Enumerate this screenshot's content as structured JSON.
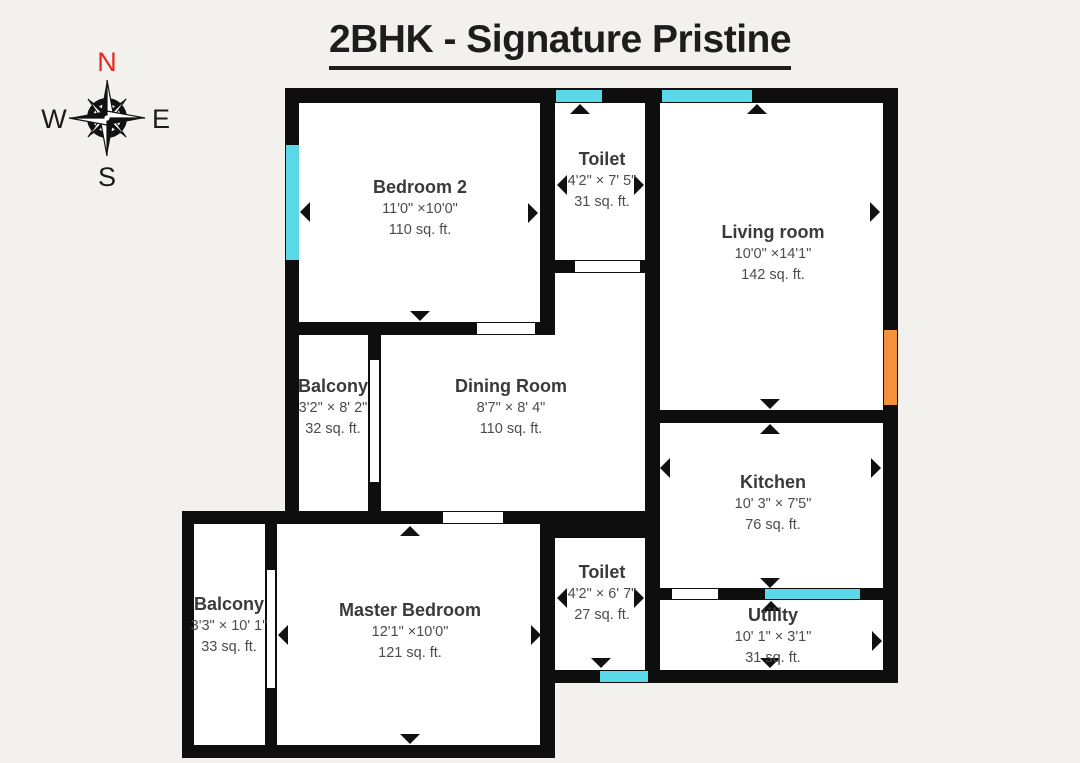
{
  "title": "2BHK - Signature Pristine",
  "compass": {
    "north": "N",
    "south": "S",
    "east": "E",
    "west": "W"
  },
  "colors": {
    "background": "#f2f1ed",
    "wall": "#0e0e0e",
    "room_fill": "#ffffff",
    "window": "#5ad8e8",
    "main_door": "#f5913d",
    "north_label": "#e8281e",
    "text": "#3a3a3a"
  },
  "rooms": [
    {
      "id": "bedroom2",
      "name": "Bedroom 2",
      "dimensions": "11'0\" ×10'0\"",
      "area": "110 sq. ft."
    },
    {
      "id": "toilet1",
      "name": "Toilet",
      "dimensions": "4'2\" × 7' 5\"",
      "area": "31 sq. ft."
    },
    {
      "id": "living",
      "name": "Living room",
      "dimensions": "10'0\" ×14'1\"",
      "area": "142 sq. ft."
    },
    {
      "id": "balcony1",
      "name": "Balcony",
      "dimensions": "3'2\" × 8' 2\"",
      "area": "32 sq. ft."
    },
    {
      "id": "dining",
      "name": "Dining Room",
      "dimensions": "8'7\" × 8' 4\"",
      "area": "110 sq. ft."
    },
    {
      "id": "kitchen",
      "name": "Kitchen",
      "dimensions": "10' 3\" × 7'5\"",
      "area": "76 sq. ft."
    },
    {
      "id": "balcony2",
      "name": "Balcony",
      "dimensions": "3'3\" × 10' 1\"",
      "area": "33 sq. ft."
    },
    {
      "id": "master",
      "name": "Master Bedroom",
      "dimensions": "12'1\" ×10'0\"",
      "area": "121 sq. ft."
    },
    {
      "id": "toilet2",
      "name": "Toilet",
      "dimensions": "4'2\" × 6' 7\"",
      "area": "27 sq. ft."
    },
    {
      "id": "utility",
      "name": "Utility",
      "dimensions": "10' 1\" × 3'1\"",
      "area": "31 sq. ft."
    }
  ]
}
